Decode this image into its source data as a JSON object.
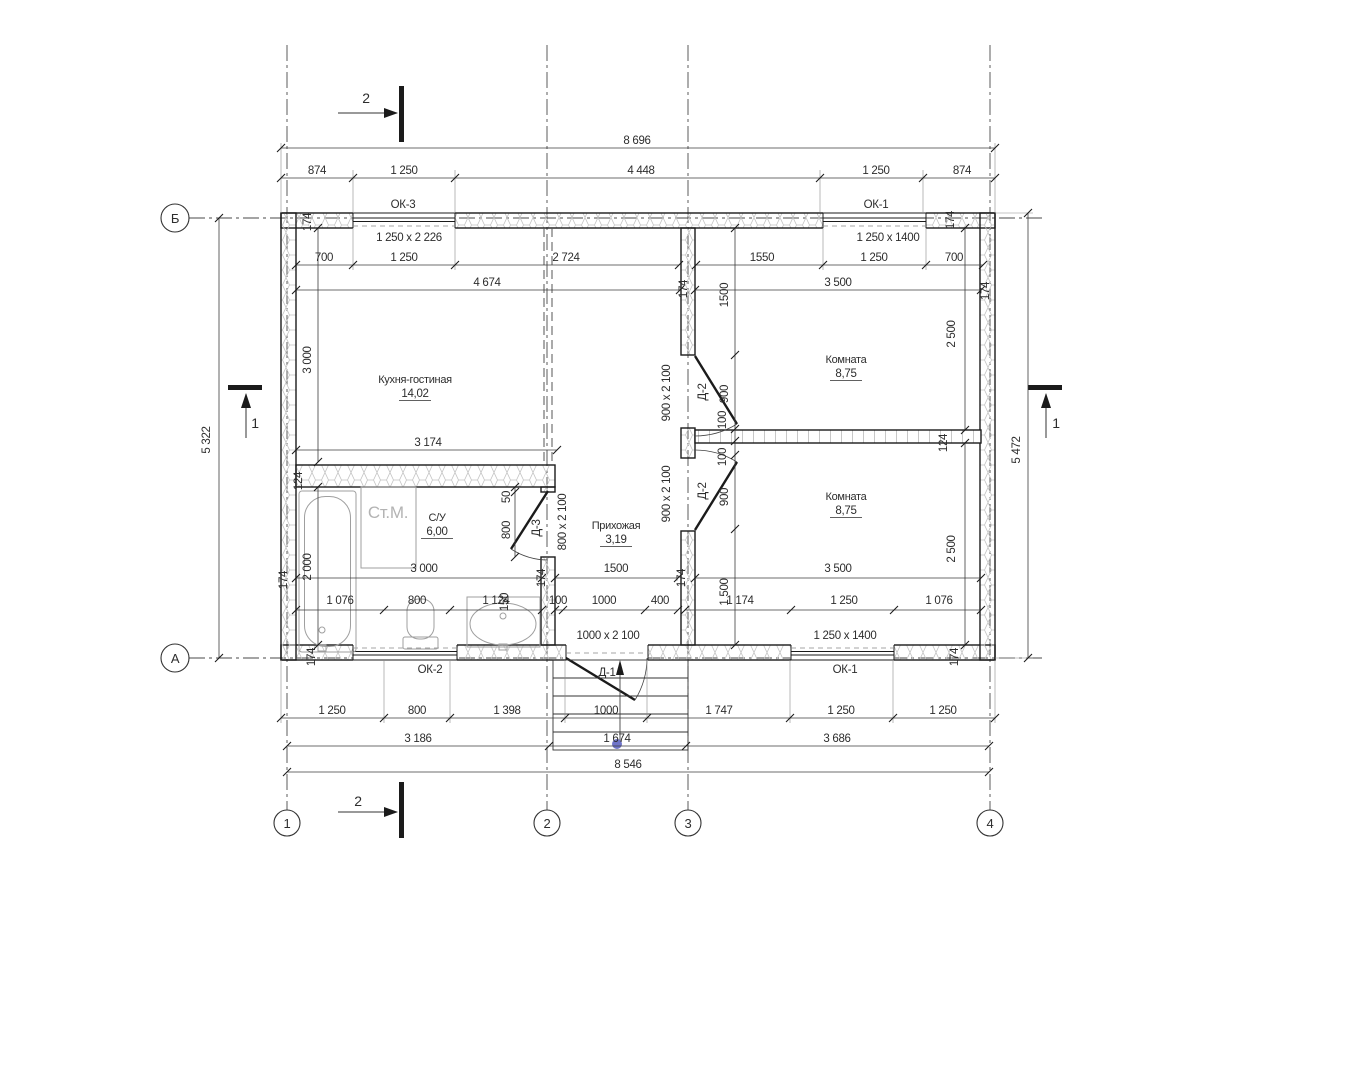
{
  "document": {
    "kind": "architectural-floor-plan"
  },
  "axes": {
    "horizontal": [
      {
        "id": "Б"
      },
      {
        "id": "А"
      }
    ],
    "vertical": [
      {
        "id": "1"
      },
      {
        "id": "2"
      },
      {
        "id": "3"
      },
      {
        "id": "4"
      }
    ],
    "section_marks": [
      {
        "id": "2",
        "location": "top"
      },
      {
        "id": "2",
        "location": "bottom"
      },
      {
        "id": "1",
        "location": "left"
      },
      {
        "id": "1",
        "location": "right"
      }
    ]
  },
  "rooms": [
    {
      "name": "Кухня-гостиная",
      "area": "14,02"
    },
    {
      "name": "Комната",
      "area": "8,75"
    },
    {
      "name": "Комната",
      "area": "8,75"
    },
    {
      "name": "С/У",
      "area": "6,00"
    },
    {
      "name": "Прихожая",
      "area": "3,19"
    }
  ],
  "windows": [
    {
      "id": "ОК-3",
      "size": "1 250 x 2 226"
    },
    {
      "id": "ОК-1",
      "size": "1 250 x 1400"
    },
    {
      "id": "ОК-2",
      "size": ""
    },
    {
      "id": "ОК-1",
      "size": "1 250 x 1400"
    }
  ],
  "doors": [
    {
      "id": "Д-1",
      "size": "1000 x 2 100"
    },
    {
      "id": "Д-2",
      "size": "900 x 2 100"
    },
    {
      "id": "Д-3",
      "size": "800 x 2 100"
    }
  ],
  "overall_dimensions": {
    "top": "8 696",
    "bottom": "8 546",
    "left": "5 322",
    "right": "5 472"
  },
  "fixtures": [
    {
      "id": "bathtub"
    },
    {
      "id": "washing-machine",
      "label": "Ст.М."
    },
    {
      "id": "toilet"
    },
    {
      "id": "sink"
    },
    {
      "id": "entry-steps"
    }
  ],
  "colors": {
    "line": "#1b1b1b",
    "dim": "#2d2d2d",
    "hatch": "#c4c4c4",
    "fixture": "#9f9f9f",
    "muted": "#b3b3b3",
    "dot": "#6f74c9"
  },
  "labels": [
    {
      "n": "dim-overall-top",
      "t": "8 696",
      "x": 637,
      "y": 144
    },
    {
      "n": "dim",
      "t": "874",
      "x": 317,
      "y": 174
    },
    {
      "n": "dim",
      "t": "1 250",
      "x": 404,
      "y": 174
    },
    {
      "n": "dim",
      "t": "4 448",
      "x": 641,
      "y": 174
    },
    {
      "n": "dim",
      "t": "1 250",
      "x": 876,
      "y": 174
    },
    {
      "n": "dim",
      "t": "874",
      "x": 962,
      "y": 174
    },
    {
      "n": "window-tag-ok3",
      "t": "ОК-3",
      "x": 403,
      "y": 208
    },
    {
      "n": "window-tag-ok1-top",
      "t": "ОК-1",
      "x": 876,
      "y": 208
    },
    {
      "n": "window-size-ok3",
      "t": "1 250 x 2 226",
      "x": 409,
      "y": 241
    },
    {
      "n": "window-size-ok1-top",
      "t": "1 250 x 1400",
      "x": 888,
      "y": 241
    },
    {
      "n": "dim",
      "t": "700",
      "x": 324,
      "y": 261
    },
    {
      "n": "dim",
      "t": "1 250",
      "x": 404,
      "y": 261
    },
    {
      "n": "dim",
      "t": "2 724",
      "x": 566,
      "y": 261
    },
    {
      "n": "dim",
      "t": "1550",
      "x": 762,
      "y": 261
    },
    {
      "n": "dim",
      "t": "1 250",
      "x": 874,
      "y": 261
    },
    {
      "n": "dim",
      "t": "700",
      "x": 954,
      "y": 261
    },
    {
      "n": "dim",
      "t": "4 674",
      "x": 487,
      "y": 286
    },
    {
      "n": "dim",
      "t": "3 500",
      "x": 838,
      "y": 286
    },
    {
      "n": "dim-wall",
      "t": "174",
      "x": 311,
      "y": 222,
      "r": 1
    },
    {
      "n": "dim-wall",
      "t": "174",
      "x": 954,
      "y": 220,
      "r": 1
    },
    {
      "n": "dim-wall",
      "t": "174",
      "x": 687,
      "y": 289,
      "r": 1
    },
    {
      "n": "dim-wall",
      "t": "174",
      "x": 989,
      "y": 291,
      "r": 1
    },
    {
      "n": "dim",
      "t": "1500",
      "x": 728,
      "y": 295,
      "r": 1
    },
    {
      "n": "dim",
      "t": "3 000",
      "x": 311,
      "y": 360,
      "r": 1
    },
    {
      "n": "door-size",
      "t": "900 x 2 100",
      "x": 670,
      "y": 393,
      "r": 1
    },
    {
      "n": "door-tag",
      "t": "Д-2",
      "x": 706,
      "y": 392,
      "r": 1
    },
    {
      "n": "dim",
      "t": "900",
      "x": 728,
      "y": 394,
      "r": 1
    },
    {
      "n": "dim",
      "t": "100",
      "x": 726,
      "y": 420,
      "r": 1
    },
    {
      "n": "dim",
      "t": "2 500",
      "x": 955,
      "y": 334,
      "r": 1
    },
    {
      "n": "room-name-kitchen",
      "t": "Кухня-гостиная",
      "x": 415,
      "y": 383,
      "s": 11
    },
    {
      "n": "room-area-kitchen",
      "t": "14,02",
      "x": 415,
      "y": 397,
      "u": 1
    },
    {
      "n": "room-name-bedroom1",
      "t": "Комната",
      "x": 846,
      "y": 363,
      "s": 11
    },
    {
      "n": "room-area-bedroom1",
      "t": "8,75",
      "x": 846,
      "y": 377,
      "u": 1
    },
    {
      "n": "dim",
      "t": "3 174",
      "x": 428,
      "y": 446
    },
    {
      "n": "dim-wall",
      "t": "124",
      "x": 947,
      "y": 443,
      "r": 1
    },
    {
      "n": "dim",
      "t": "100",
      "x": 726,
      "y": 457,
      "r": 1
    },
    {
      "n": "door-size",
      "t": "900 x 2 100",
      "x": 670,
      "y": 494,
      "r": 1
    },
    {
      "n": "door-tag",
      "t": "Д-2",
      "x": 706,
      "y": 491,
      "r": 1
    },
    {
      "n": "dim",
      "t": "900",
      "x": 728,
      "y": 497,
      "r": 1
    },
    {
      "n": "room-name-bedroom2",
      "t": "Комната",
      "x": 846,
      "y": 500,
      "s": 11
    },
    {
      "n": "room-area-bedroom2",
      "t": "8,75",
      "x": 846,
      "y": 514,
      "u": 1
    },
    {
      "n": "dim",
      "t": "2 500",
      "x": 955,
      "y": 549,
      "r": 1
    },
    {
      "n": "dim-wall",
      "t": "124",
      "x": 302,
      "y": 481,
      "r": 1
    },
    {
      "n": "dim",
      "t": "50",
      "x": 510,
      "y": 497,
      "r": 1
    },
    {
      "n": "door-tag",
      "t": "Д-3",
      "x": 540,
      "y": 528,
      "r": 1
    },
    {
      "n": "dim",
      "t": "800",
      "x": 510,
      "y": 530,
      "r": 1
    },
    {
      "n": "door-size",
      "t": "800 x 2 100",
      "x": 566,
      "y": 522,
      "r": 1
    },
    {
      "n": "fixture-label-wm",
      "t": "Ст.М.",
      "x": 388,
      "y": 518,
      "s": 17,
      "c": 1
    },
    {
      "n": "room-name-bath",
      "t": "С/У",
      "x": 437,
      "y": 521,
      "s": 11
    },
    {
      "n": "room-area-bath",
      "t": "6,00",
      "x": 437,
      "y": 535,
      "u": 1
    },
    {
      "n": "room-name-hall",
      "t": "Прихожая",
      "x": 616,
      "y": 529,
      "s": 11
    },
    {
      "n": "room-area-hall",
      "t": "3,19",
      "x": 616,
      "y": 543,
      "u": 1
    },
    {
      "n": "dim",
      "t": "2 000",
      "x": 311,
      "y": 567,
      "r": 1
    },
    {
      "n": "dim-wall",
      "t": "174",
      "x": 287,
      "y": 580,
      "r": 1
    },
    {
      "n": "dim-wall",
      "t": "174",
      "x": 545,
      "y": 578,
      "r": 1
    },
    {
      "n": "dim-wall",
      "t": "174",
      "x": 685,
      "y": 578,
      "r": 1
    },
    {
      "n": "dim",
      "t": "3 000",
      "x": 424,
      "y": 572
    },
    {
      "n": "dim",
      "t": "1500",
      "x": 616,
      "y": 572
    },
    {
      "n": "dim",
      "t": "3 500",
      "x": 838,
      "y": 572
    },
    {
      "n": "dim",
      "t": "1 500",
      "x": 728,
      "y": 592,
      "r": 1
    },
    {
      "n": "dim",
      "t": "150",
      "x": 508,
      "y": 602,
      "r": 1
    },
    {
      "n": "dim",
      "t": "1 076",
      "x": 340,
      "y": 604
    },
    {
      "n": "dim",
      "t": "800",
      "x": 417,
      "y": 604
    },
    {
      "n": "dim",
      "t": "1 124",
      "x": 496,
      "y": 604
    },
    {
      "n": "dim",
      "t": "100",
      "x": 558,
      "y": 604
    },
    {
      "n": "dim",
      "t": "1000",
      "x": 604,
      "y": 604
    },
    {
      "n": "dim",
      "t": "400",
      "x": 660,
      "y": 604
    },
    {
      "n": "dim",
      "t": "1 174",
      "x": 740,
      "y": 604
    },
    {
      "n": "dim",
      "t": "1 250",
      "x": 844,
      "y": 604
    },
    {
      "n": "dim",
      "t": "1 076",
      "x": 939,
      "y": 604
    },
    {
      "n": "door-size-d1",
      "t": "1000 x 2 100",
      "x": 608,
      "y": 639
    },
    {
      "n": "window-size-ok1-bottom",
      "t": "1 250 x 1400",
      "x": 845,
      "y": 639
    },
    {
      "n": "dim-wall",
      "t": "174",
      "x": 315,
      "y": 657,
      "r": 1
    },
    {
      "n": "dim-wall",
      "t": "174",
      "x": 958,
      "y": 657,
      "r": 1
    },
    {
      "n": "window-tag-ok2",
      "t": "ОК-2",
      "x": 430,
      "y": 673
    },
    {
      "n": "door-tag-d1",
      "t": "Д-1",
      "x": 607,
      "y": 676
    },
    {
      "n": "window-tag-ok1-bottom",
      "t": "ОК-1",
      "x": 845,
      "y": 673
    },
    {
      "n": "dim",
      "t": "1 250",
      "x": 332,
      "y": 714
    },
    {
      "n": "dim",
      "t": "800",
      "x": 417,
      "y": 714
    },
    {
      "n": "dim",
      "t": "1 398",
      "x": 507,
      "y": 714
    },
    {
      "n": "dim",
      "t": "1000",
      "x": 606,
      "y": 714
    },
    {
      "n": "dim",
      "t": "1 747",
      "x": 719,
      "y": 714
    },
    {
      "n": "dim",
      "t": "1 250",
      "x": 841,
      "y": 714
    },
    {
      "n": "dim",
      "t": "1 250",
      "x": 943,
      "y": 714
    },
    {
      "n": "dim",
      "t": "3 186",
      "x": 418,
      "y": 742
    },
    {
      "n": "dim",
      "t": "1 674",
      "x": 617,
      "y": 742
    },
    {
      "n": "dim",
      "t": "3 686",
      "x": 837,
      "y": 742
    },
    {
      "n": "dim-overall-bottom",
      "t": "8 546",
      "x": 628,
      "y": 768
    },
    {
      "n": "dim-overall-left",
      "t": "5 322",
      "x": 210,
      "y": 440,
      "r": 1
    },
    {
      "n": "dim-overall-right",
      "t": "5 472",
      "x": 1020,
      "y": 450,
      "r": 1
    },
    {
      "n": "section-label",
      "t": "2",
      "x": 366,
      "y": 103,
      "s": 14
    },
    {
      "n": "section-label",
      "t": "2",
      "x": 358,
      "y": 806,
      "s": 14
    },
    {
      "n": "section-label",
      "t": "1",
      "x": 255,
      "y": 428,
      "s": 14
    },
    {
      "n": "section-label",
      "t": "1",
      "x": 1056,
      "y": 428,
      "s": 14
    },
    {
      "n": "axis-label",
      "t": "Б",
      "x": 175,
      "y": 223,
      "s": 13
    },
    {
      "n": "axis-label",
      "t": "А",
      "x": 175,
      "y": 663,
      "s": 13
    },
    {
      "n": "axis-label",
      "t": "1",
      "x": 287,
      "y": 828,
      "s": 13
    },
    {
      "n": "axis-label",
      "t": "2",
      "x": 547,
      "y": 828,
      "s": 13
    },
    {
      "n": "axis-label",
      "t": "3",
      "x": 688,
      "y": 828,
      "s": 13
    },
    {
      "n": "axis-label",
      "t": "4",
      "x": 990,
      "y": 828,
      "s": 13
    }
  ]
}
